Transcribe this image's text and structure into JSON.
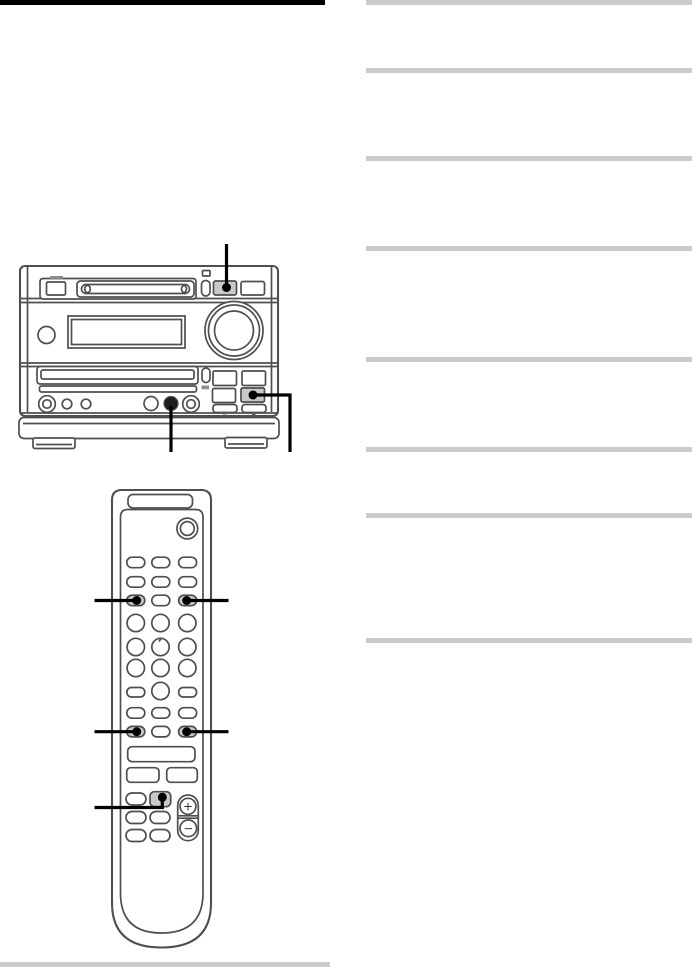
{
  "colors": {
    "page_bg": "#ffffff",
    "section_bar": "#000000",
    "rule": "#cbcbcb",
    "outline": "#4f4f4f",
    "button_shade": "#c9c9c9",
    "callout": "#000000"
  },
  "right_column": {
    "rules": [
      {
        "y": 0
      },
      {
        "y": 68
      },
      {
        "y": 156
      },
      {
        "y": 246
      },
      {
        "y": 357
      },
      {
        "y": 447
      },
      {
        "y": 513
      },
      {
        "y": 638
      }
    ]
  },
  "illustrations": {
    "main_unit": {
      "type": "md-cd-mini-system-front-view",
      "callouts": [
        "top-panel-button",
        "lower-right-button",
        "phones-jack"
      ]
    },
    "remote": {
      "type": "remote-control-front-view",
      "callouts": [
        "row3-left-button",
        "row3-right-button",
        "row6-left-button",
        "row6-right-button",
        "center-square-button"
      ],
      "volume_plus": "+",
      "volume_minus": "−"
    }
  }
}
